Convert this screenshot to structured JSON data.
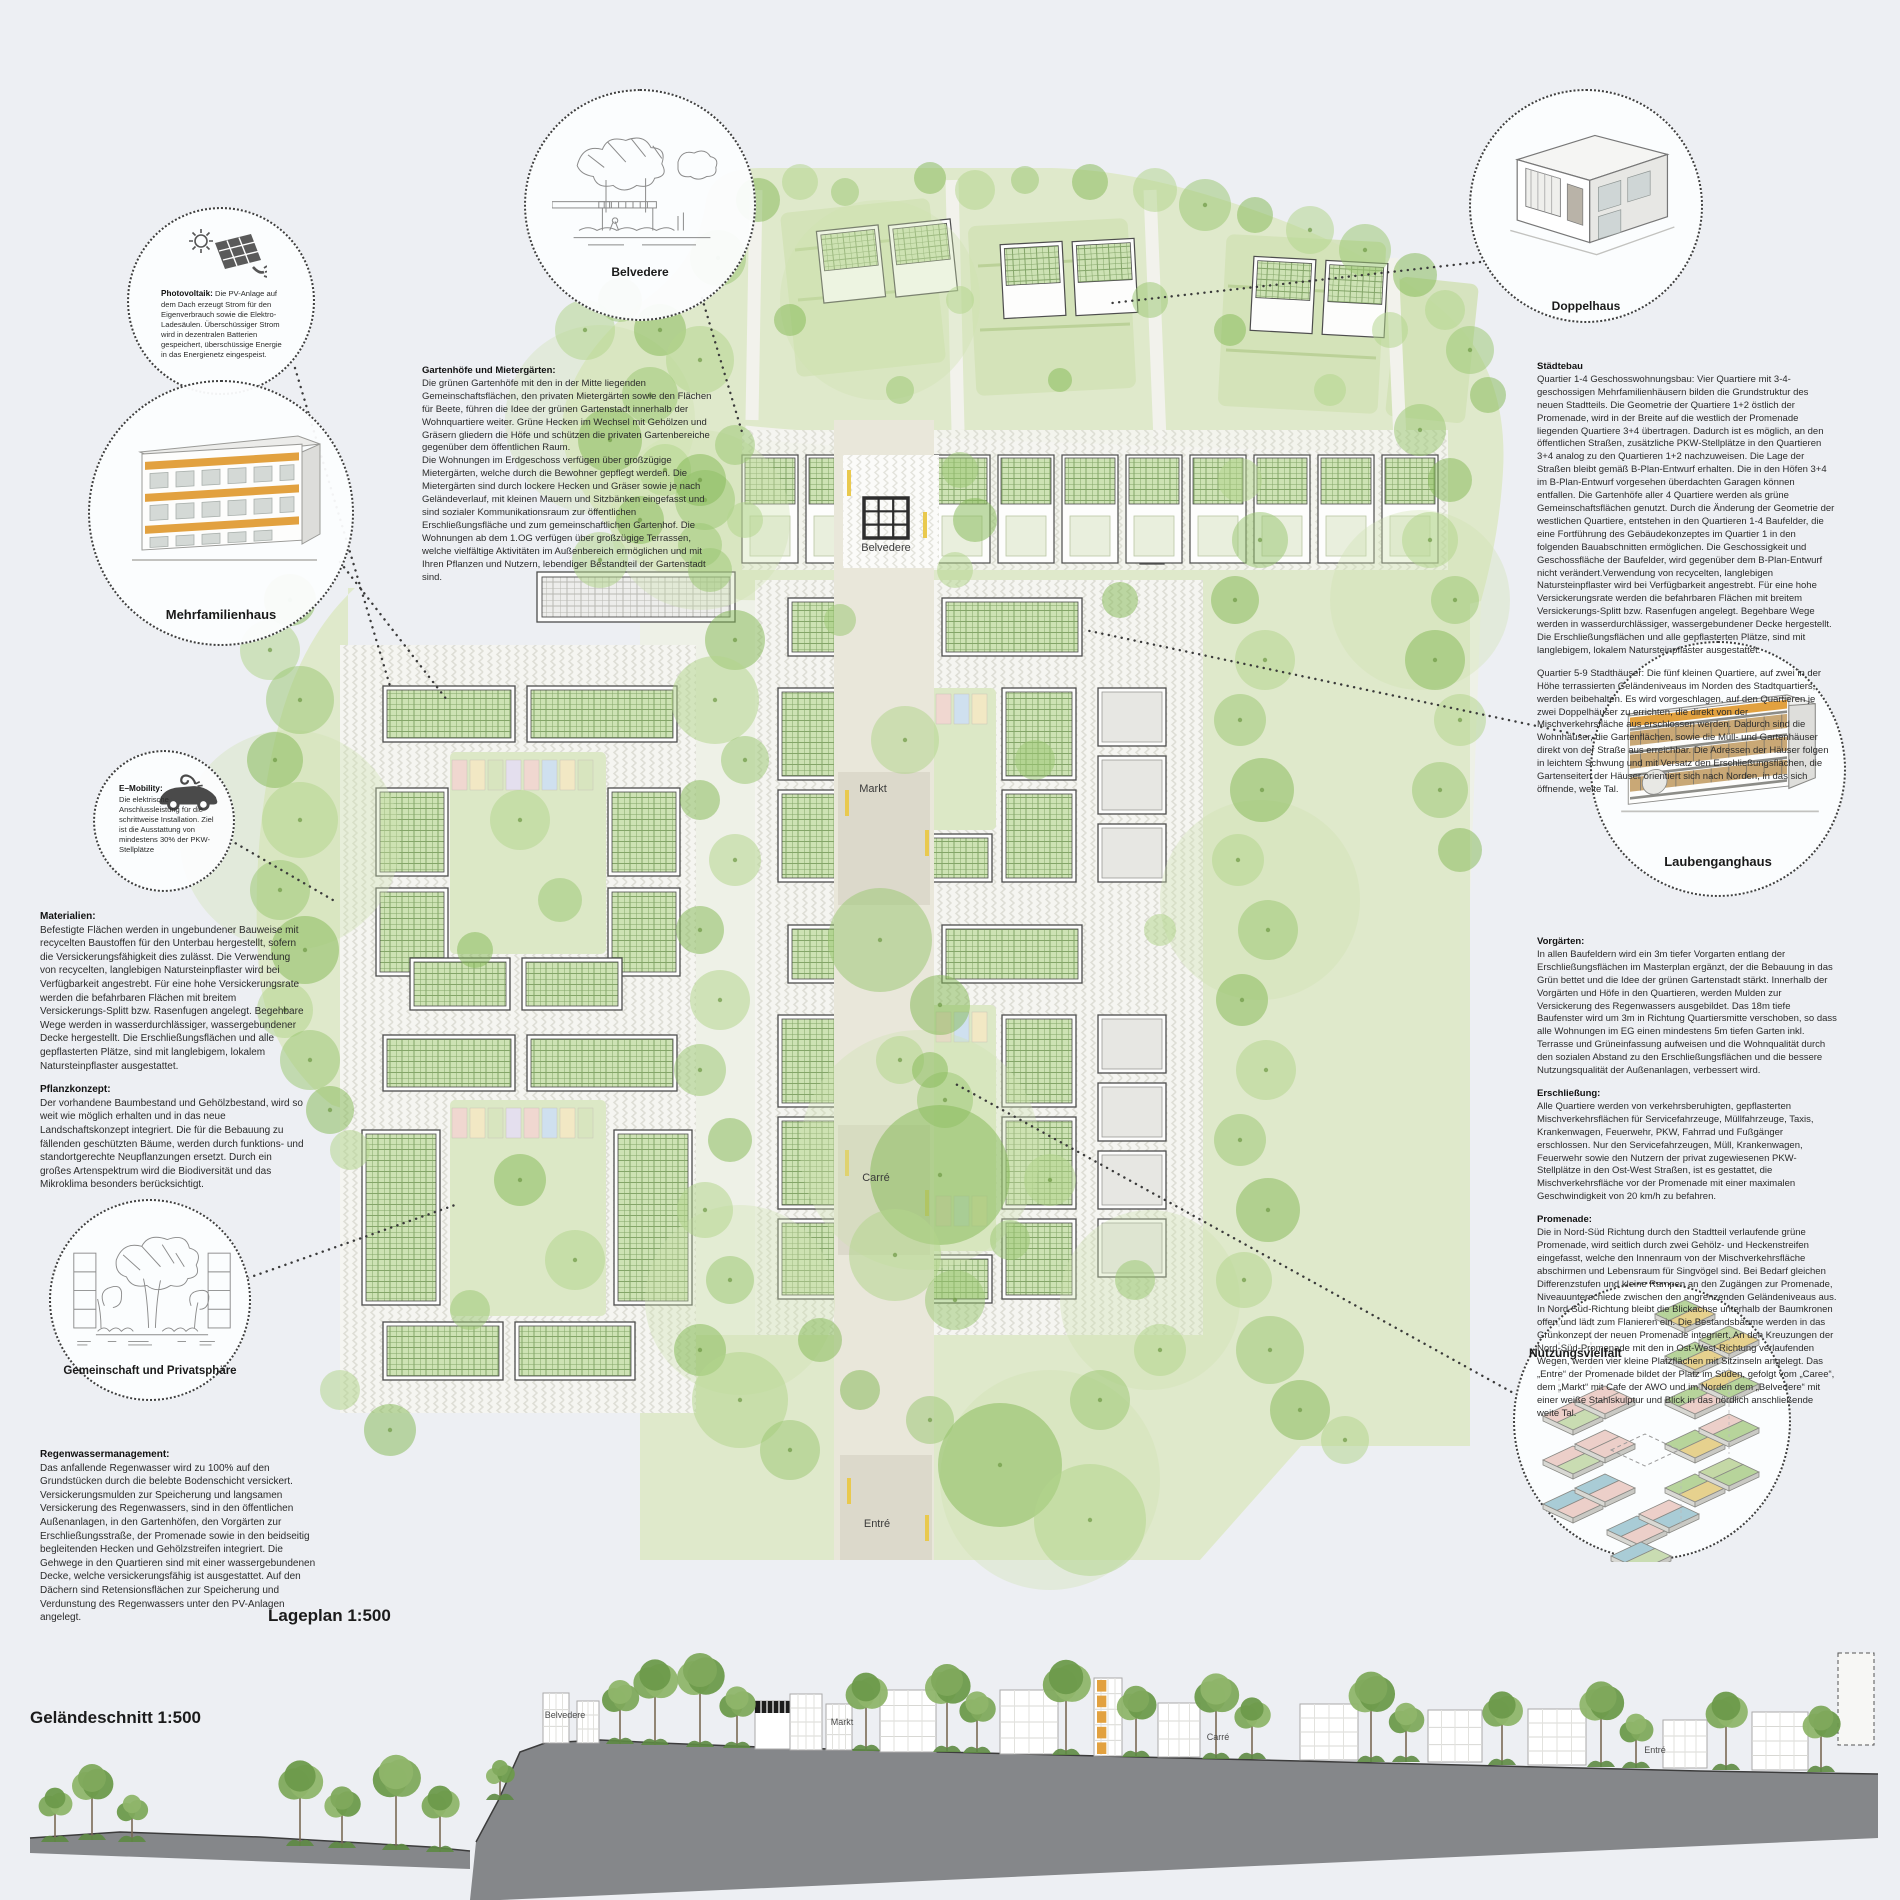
{
  "board": {
    "title_plan": "Lageplan 1:500",
    "title_section": "Geländeschnitt 1:500"
  },
  "colors": {
    "paper": "#edeff3",
    "tree_green": "#8fbf63",
    "pv_roof_green": "#cde2b4",
    "hill_green": "#dfe9cb",
    "accent_orange": "#e2a13f",
    "plaza_beige": "#dcd9cb"
  },
  "callouts": {
    "photovoltaik": {
      "icon": "solar-panel-sun-icon",
      "title": "Photovoltaik:",
      "text": "Die PV-Anlage auf dem Dach erzeugt Strom für den Eigenverbrauch sowie die Elektro-Ladesäulen. Überschüssiger Strom wird in dezentralen Batterien gespeichert, überschüssige Energie in das Energienetz eingespeist."
    },
    "mehrfamilienhaus": {
      "icon": "apartment-building-illustration",
      "label": "Mehrfamilienhaus"
    },
    "emobility": {
      "icon": "electric-car-icon",
      "title": "E–Mobility:",
      "text": "Die elektrische Anschlussleistung für die schrittweise Installation. Ziel ist die Ausstattung von mindestens 30% der PKW-Stellplätze"
    },
    "gemeinschaft": {
      "icon": "hand-sketch-trees",
      "label": "Gemeinschaft und Privatsphäre"
    },
    "belvedere": {
      "icon": "hand-sketch-pergola",
      "label": "Belvedere"
    },
    "doppelhaus": {
      "icon": "duplex-house-illustration",
      "label": "Doppelhaus"
    },
    "laubenganghaus": {
      "icon": "gallery-house-illustration",
      "label": "Laubenganghaus"
    },
    "nutzungsvielfalt": {
      "icon": "floorplan-axonometry",
      "label": "Nutzungsvielfalt"
    }
  },
  "textblocks": {
    "gartenhoefe": {
      "title": "Gartenhöfe und Mietergärten:",
      "body": "Die grünen Gartenhöfe mit den in der Mitte liegenden Gemeinschaftsflächen, den privaten Mietergärten sowie den Flächen für Beete, führen die Idee der grünen Gartenstadt innerhalb der Wohnquartiere weiter. Grüne Hecken im Wechsel mit Gehölzen und Gräsern gliedern die Höfe und schützen die privaten Gartenbereiche gegenüber dem öffentlichen Raum.\nDie Wohnungen im Erdgeschoss verfügen über großzügige Mietergärten, welche durch die Bewohner gepflegt werden. Die Mietergärten sind durch lockere Hecken und Gräser sowie je nach Geländeverlauf, mit kleinen Mauern und Sitzbänken eingefasst und sind sozialer Kommunikationsraum zur öffentlichen Erschließungsfläche und zum gemeinschaftlichen Gartenhof. Die Wohnungen ab dem 1.OG verfügen über großzügige Terrassen, welche vielfältige Aktivitäten im Außenbereich ermöglichen und mit Ihren Pflanzen und Nutzern, lebendiger Bestandteil der Gartenstadt sind."
    },
    "staedtebau": {
      "title": "Städtebau",
      "p1": "Quartier 1-4 Geschosswohnungsbau: Vier Quartiere mit 3-4-geschossigen Mehrfamilienhäusern bilden die Grundstruktur des neuen Stadtteils. Die Geometrie der Quartiere 1+2 östlich der Promenade, wird in der Breite auf die westlich der Promenade liegenden Quartiere 3+4 übertragen. Dadurch ist es möglich, an den öffentlichen Straßen, zusätzliche PKW-Stellplätze in den Quartieren 3+4 analog zu den Quartieren 1+2 nachzuweisen. Die Lage der Straßen bleibt gemäß B-Plan-Entwurf erhalten. Die in den Höfen 3+4 im B-Plan-Entwurf vorgesehen überdachten Garagen können entfallen. Die Gartenhöfe aller 4 Quartiere werden als grüne Gemeinschaftsflächen genutzt. Durch die Änderung der Geometrie der westlichen Quartiere, entstehen in den Quartieren 1-4 Baufelder, die eine Fortführung des Gebäudekonzeptes im Quartier 1 in den folgenden Bauabschnitten ermöglichen. Die Geschossigkeit und Geschossfläche der Baufelder, wird gegenüber dem B-Plan-Entwurf nicht verändert.Verwendung von recycelten, langlebigen Natursteinpflaster wird bei Verfügbarkeit angestrebt. Für eine hohe Versickerungsrate werden die befahrbaren Flächen mit breitem Versickerungs-Splitt bzw. Rasenfugen angelegt. Begehbare Wege werden in wasserdurchlässiger, wassergebundener Decke hergestellt. Die Erschließungsflächen und alle gepflasterten Plätze, sind mit langlebigem, lokalem Natursteinpflaster ausgestattet.",
      "p2": "Quartier 5-9 Stadthäuser: Die fünf kleinen Quartiere, auf zwei in der Höhe terrassierten Geländeniveaus im Norden des Stadtquartiers, werden beibehalten. Es wird vorgeschlagen, auf den Quartieren je zwei Doppelhäuser zu errichten, die direkt von der Mischverkehrsfläche aus erschlossen werden. Dadurch sind die Wohnhäuser, die Gartenflächen, sowie die Müll- und Gartenhäuser direkt von der Straße aus erreichbar. Die Adressen der Häuser folgen in leichtem Schwung und mit Versatz den Erschließungsflächen, die Gartenseiten der Häuser orientiert sich nach Norden, in das sich öffnende, weite Tal."
    },
    "materialien": {
      "title": "Materialien:",
      "body": "Befestigte Flächen werden in ungebundener Bauweise mit recycelten Baustoffen für den Unterbau hergestellt, sofern die Versickerungsfähigkeit dies zulässt. Die Verwendung von recycelten, langlebigen Natursteinpflaster wird bei Verfügbarkeit angestrebt. Für eine hohe Versickerungsrate werden die befahrbaren Flächen mit breitem Versickerungs-Splitt bzw. Rasenfugen angelegt. Begehbare Wege werden in wasserdurchlässiger, wassergebundener Decke hergestellt. Die Erschließungsflächen und alle gepflasterten Plätze, sind mit langlebigem, lokalem Natursteinpflaster ausgestattet."
    },
    "pflanzkonzept": {
      "title": "Pflanzkonzept:",
      "body": "Der vorhandene Baumbestand und Gehölzbestand, wird so weit wie möglich erhalten und in das neue Landschaftskonzept integriert. Die für die Bebauung zu fällenden geschützten Bäume, werden durch funktions- und standortgerechte Neupflanzungen ersetzt. Durch ein großes Artenspektrum wird die Biodiversität und das Mikroklima besonders berücksichtigt."
    },
    "regenwasser": {
      "title": "Regenwassermanagement:",
      "body": "Das anfallende Regenwasser wird zu 100% auf den Grundstücken durch die belebte Bodenschicht versickert. Versickerungsmulden zur Speicherung und langsamen Versickerung des Regenwassers, sind in den öffentlichen Außenanlagen, in den Gartenhöfen, den Vorgärten zur Erschließungsstraße, der Promenade sowie in den beidseitig begleitenden Hecken und Gehölzstreifen integriert. Die Gehwege in den Quartieren sind mit einer wassergebundenen Decke, welche versickerungsfähig ist ausgestattet. Auf den Dächern sind Retensionsflächen zur Speicherung und Verdunstung des Regenwassers unter den PV-Anlagen angelegt."
    },
    "vorgaerten": {
      "title": "Vorgärten:",
      "body": "In allen Baufeldern wird ein 3m tiefer Vorgarten entlang der Erschließungsflächen im Masterplan ergänzt, der die Bebauung in das Grün bettet und die Idee der grünen Gartenstadt stärkt. Innerhalb der Vorgärten und Höfe in den Quartieren, werden Mulden zur Versickerung des Regenwassers ausgebildet. Das 18m tiefe Baufenster wird um 3m in Richtung Quartiersmitte verschoben, so dass alle Wohnungen im EG einen mindestens 5m tiefen Garten inkl. Terrasse und Grüneinfassung aufweisen und die Wohnqualität durch den sozialen Abstand zu den Erschließungsflächen und die bessere Nutzungsqualität der Außenanlagen, verbessert wird."
    },
    "erschliessung": {
      "title": "Erschließung:",
      "body": "Alle Quartiere werden von verkehrsberuhigten, gepflasterten Mischverkehrsflächen für Servicefahrzeuge, Müllfahrzeuge, Taxis, Krankenwagen, Feuerwehr, PKW, Fahrrad und Fußgänger erschlossen. Nur den Servicefahrzeugen, Müll, Krankenwagen, Feuerwehr sowie den Nutzern der privat zugewiesenen PKW-Stellplätze in den Ost-West Straßen, ist es gestattet, die Mischverkehrsfläche vor der Promenade mit einer maximalen Geschwindigkeit von 20 km/h zu befahren."
    },
    "promenade": {
      "title": "Promenade:",
      "body": "Die in Nord-Süd Richtung durch den Stadtteil verlaufende grüne Promenade, wird seitlich durch zwei Gehölz- und Heckenstreifen eingefasst, welche den Innenraum von der Mischverkehrsfläche abschirmen und Lebensraum für Singvögel sind. Bei Bedarf gleichen Differenzstufen und kleine Rampen an den Zugängen zur Promenade, Niveauunterschiede zwischen den angrenzenden Geländeniveaus aus. In Nord-Süd-Richtung bleibt die Blickachse unterhalb der Baumkronen offen und lädt zum Flanieren ein. Die Bestandsbäume werden in das Grünkonzept der neuen Promenade integriert. An den Kreuzungen der Nord-Süd-Promenade mit den in Ost-West-Richtung verlaufenden Wegen, werden vier kleine Platzflächen mit Sitzinseln angelegt. Das „Entre“ der Promenade bildet der Platz im Süden, gefolgt vom „Caree“, dem „Markt“ mit Cafe der AWO und im Norden dem „Belvedere“ mit einer weiße Stahlskulptur und Blick in das nördlich anschließende weite Tal."
    }
  },
  "plan_labels": {
    "belvedere": "Belvedere",
    "markt": "Markt",
    "carre": "Carré",
    "entre": "Entré"
  },
  "section_labels": {
    "belvedere": "Belvedere",
    "markt": "Markt",
    "carre": "Carré",
    "entre": "Entré"
  }
}
